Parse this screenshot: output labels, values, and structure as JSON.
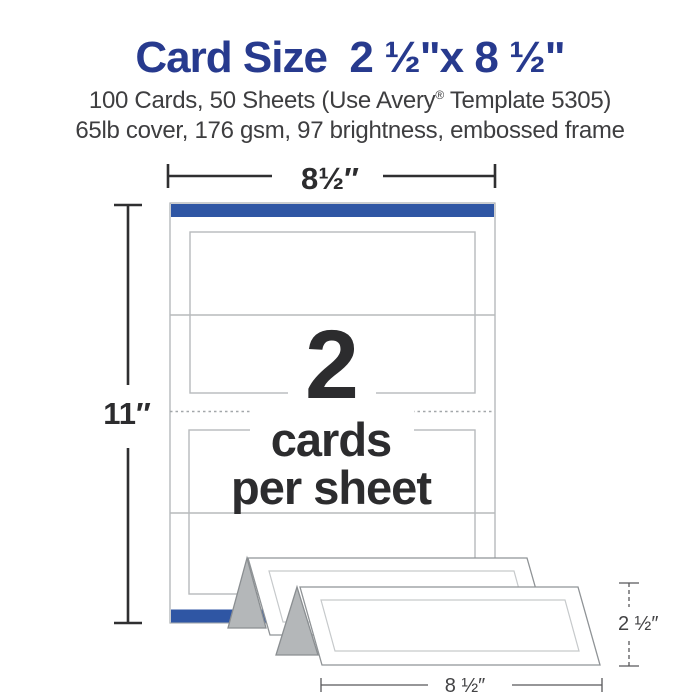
{
  "header": {
    "title": "Card Size  2 ½\"x 8 ½\"",
    "subtitle1": {
      "pre": "100 Cards, 50 Sheets (Use Avery",
      "sup": "®",
      "post": " Template 5305)"
    },
    "subtitle2": "65lb cover, 176 gsm, 97 brightness, embossed frame"
  },
  "diagram": {
    "sheet_width_label": "8½″",
    "sheet_height_label": "11″",
    "cards_per_sheet": {
      "count": "2",
      "caption_line1": "cards",
      "caption_line2": "per sheet"
    },
    "card_height_label": "2 ½″",
    "card_width_label": "8 ½″"
  },
  "colors": {
    "title_blue": "#273a8e",
    "accent_bar_blue": "#2f56a4",
    "body_text": "#3e3e40",
    "diagram_text": "#2c2c2e",
    "card_outline_gray": "#b7babc",
    "tent_fold_gray": "#b4b7b9"
  }
}
